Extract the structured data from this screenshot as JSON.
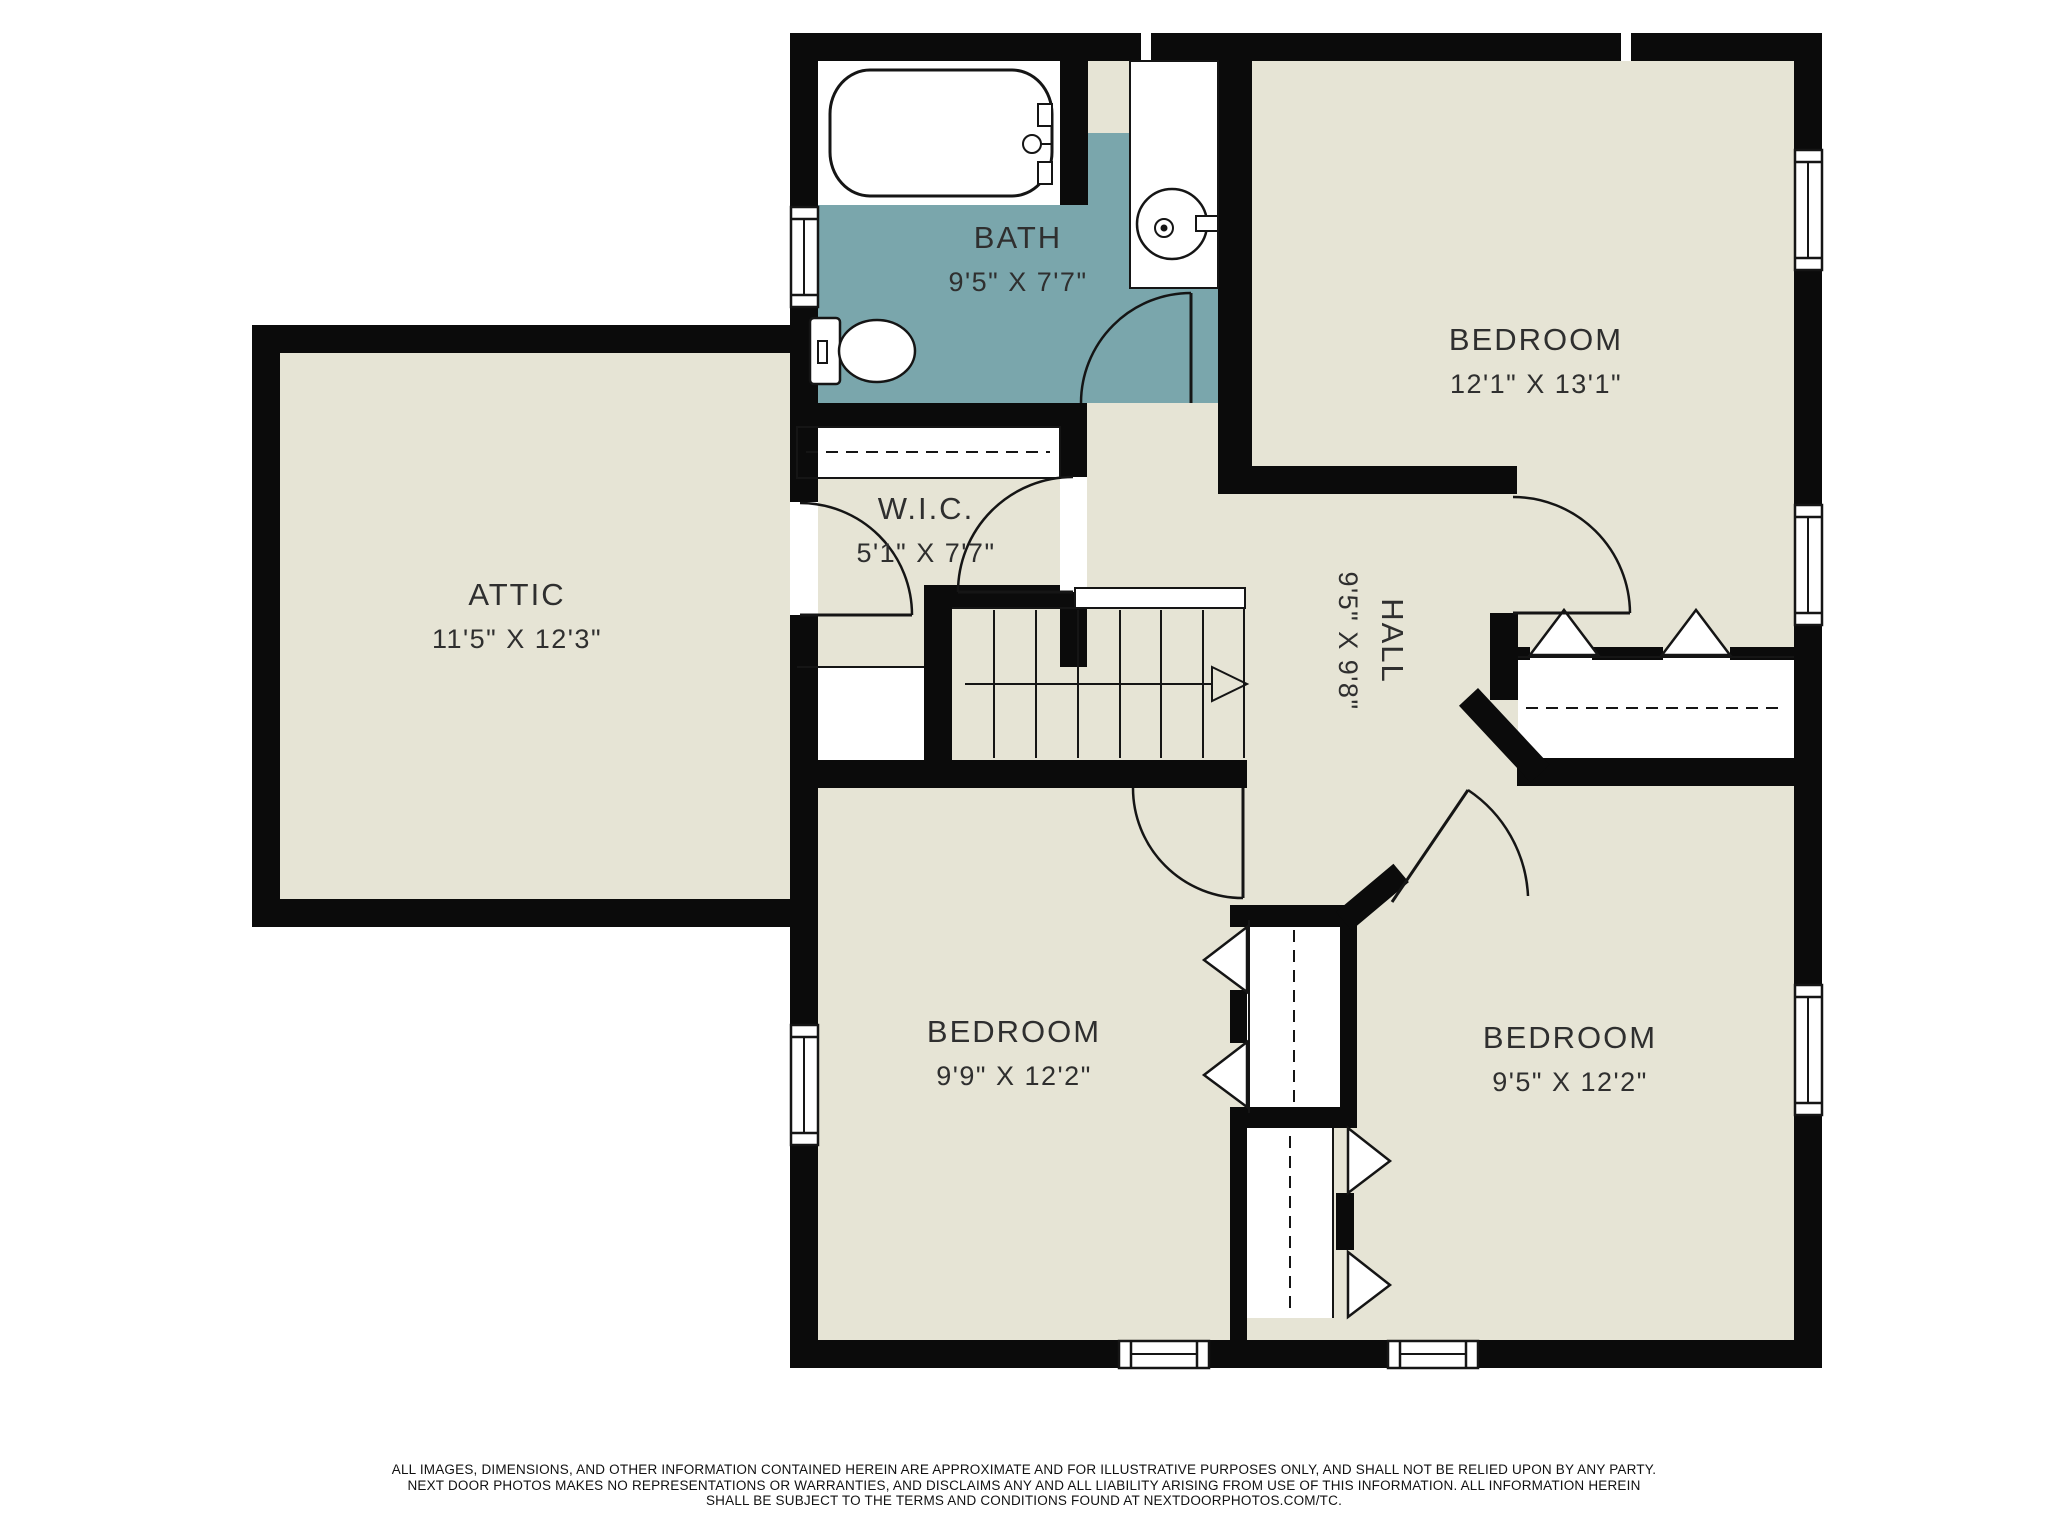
{
  "colors": {
    "floor": "#e6e4d5",
    "bath": "#7aa6ac",
    "wall": "#0b0b0b",
    "line": "#151515",
    "text": "#2f2f2f",
    "paper": "#ffffff"
  },
  "rooms": {
    "bath": {
      "name": "BATH",
      "dims": "9'5\" X 7'7\""
    },
    "bedroom_top_right": {
      "name": "BEDROOM",
      "dims": "12'1\" X 13'1\""
    },
    "attic": {
      "name": "ATTIC",
      "dims": "11'5\" X 12'3\""
    },
    "wic": {
      "name": "W.I.C.",
      "dims": "5'1\" X 7'7\""
    },
    "hall": {
      "name": "HALL",
      "dims": "9'5\" X 9'8\""
    },
    "bedroom_bottom_left": {
      "name": "BEDROOM",
      "dims": "9'9\" X 12'2\""
    },
    "bedroom_bottom_right": {
      "name": "BEDROOM",
      "dims": "9'5\" X 12'2\""
    }
  },
  "fixtures": [
    "bathtub",
    "toilet",
    "sink-vanity",
    "staircase-up-arrow",
    "closet-rod-dashed",
    "bifold-closet-doors",
    "swing-doors",
    "windows"
  ],
  "disclaimer": {
    "line1": "ALL IMAGES, DIMENSIONS, AND OTHER INFORMATION CONTAINED HEREIN ARE APPROXIMATE AND FOR ILLUSTRATIVE PURPOSES ONLY, AND SHALL NOT BE RELIED UPON BY ANY PARTY.",
    "line2": "NEXT DOOR PHOTOS MAKES NO REPRESENTATIONS OR WARRANTIES, AND DISCLAIMS ANY AND ALL LIABILITY ARISING FROM USE OF THIS INFORMATION. ALL INFORMATION HEREIN",
    "line3": "SHALL BE SUBJECT TO THE TERMS AND CONDITIONS FOUND AT NEXTDOORPHOTOS.COM/TC."
  }
}
